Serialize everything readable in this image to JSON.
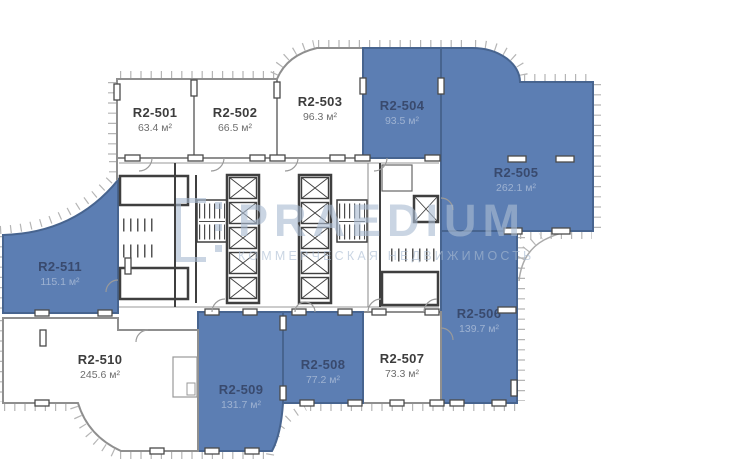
{
  "watermark": {
    "brand": "PRAEDIUM",
    "tagline": "КОММЕРЧЕСКАЯ НЕДВИЖИМОСТЬ"
  },
  "plan": {
    "colors": {
      "highlight": "#5c7eb3",
      "highlight_border": "#47648f",
      "room": "#ffffff",
      "wall": "#8f8f8f",
      "core_wall": "#3f3f3f",
      "label": "#3d3d3d",
      "area_label": "#6d6d6d",
      "label_on_highlight": "#394a6e",
      "watermark": "#aabcd2"
    },
    "units": [
      {
        "name": "R2-501",
        "area": "63.4 м²",
        "highlighted": false
      },
      {
        "name": "R2-502",
        "area": "66.5 м²",
        "highlighted": false
      },
      {
        "name": "R2-503",
        "area": "96.3 м²",
        "highlighted": false
      },
      {
        "name": "R2-504",
        "area": "93.5 м²",
        "highlighted": true
      },
      {
        "name": "R2-505",
        "area": "262.1 м²",
        "highlighted": true
      },
      {
        "name": "R2-506",
        "area": "139.7 м²",
        "highlighted": true
      },
      {
        "name": "R2-507",
        "area": "73.3 м²",
        "highlighted": false
      },
      {
        "name": "R2-508",
        "area": "77.2 м²",
        "highlighted": true
      },
      {
        "name": "R2-509",
        "area": "131.7 м²",
        "highlighted": true
      },
      {
        "name": "R2-510",
        "area": "245.6 м²",
        "highlighted": false
      },
      {
        "name": "R2-511",
        "area": "115.1 м²",
        "highlighted": true
      }
    ]
  }
}
